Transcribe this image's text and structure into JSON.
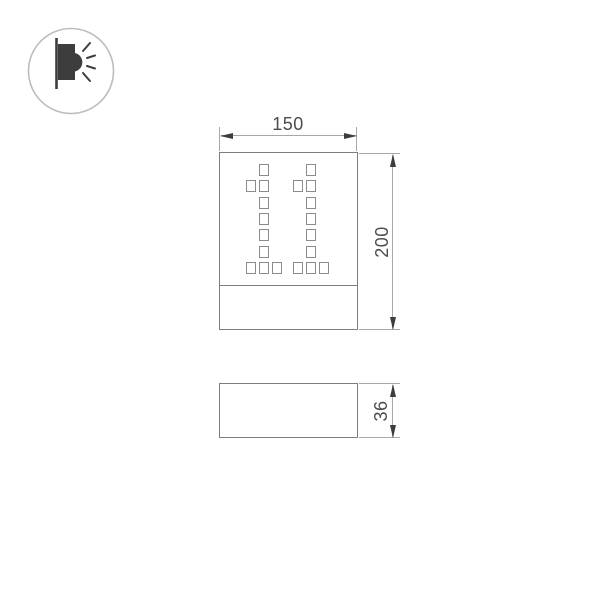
{
  "logo": {
    "icon": "wall-lamp-light-icon",
    "description": "circled pictogram of a wall-mounted luminaire emitting light"
  },
  "views": {
    "front": {
      "name": "front-view",
      "dimension_width": {
        "value": "150"
      },
      "dimension_height": {
        "value": "200"
      },
      "led_digits": [
        {
          "char": "1",
          "pattern": [
            "010",
            "110",
            "010",
            "010",
            "010",
            "010",
            "111"
          ]
        },
        {
          "char": "1",
          "pattern": [
            "010",
            "110",
            "010",
            "010",
            "010",
            "010",
            "111"
          ]
        }
      ]
    },
    "side": {
      "name": "side-view",
      "dimension_depth": {
        "value": "36"
      }
    }
  },
  "colors": {
    "outline_gray": "#7d7d7d",
    "dim_line_gray": "#a8a8a8",
    "cell_border_gray": "#8c8c8c",
    "arrow_dark": "#3d3d3d",
    "text_dark": "#4c4c4c",
    "logo_circle_gray": "#bdbdbd",
    "background": "#ffffff"
  }
}
